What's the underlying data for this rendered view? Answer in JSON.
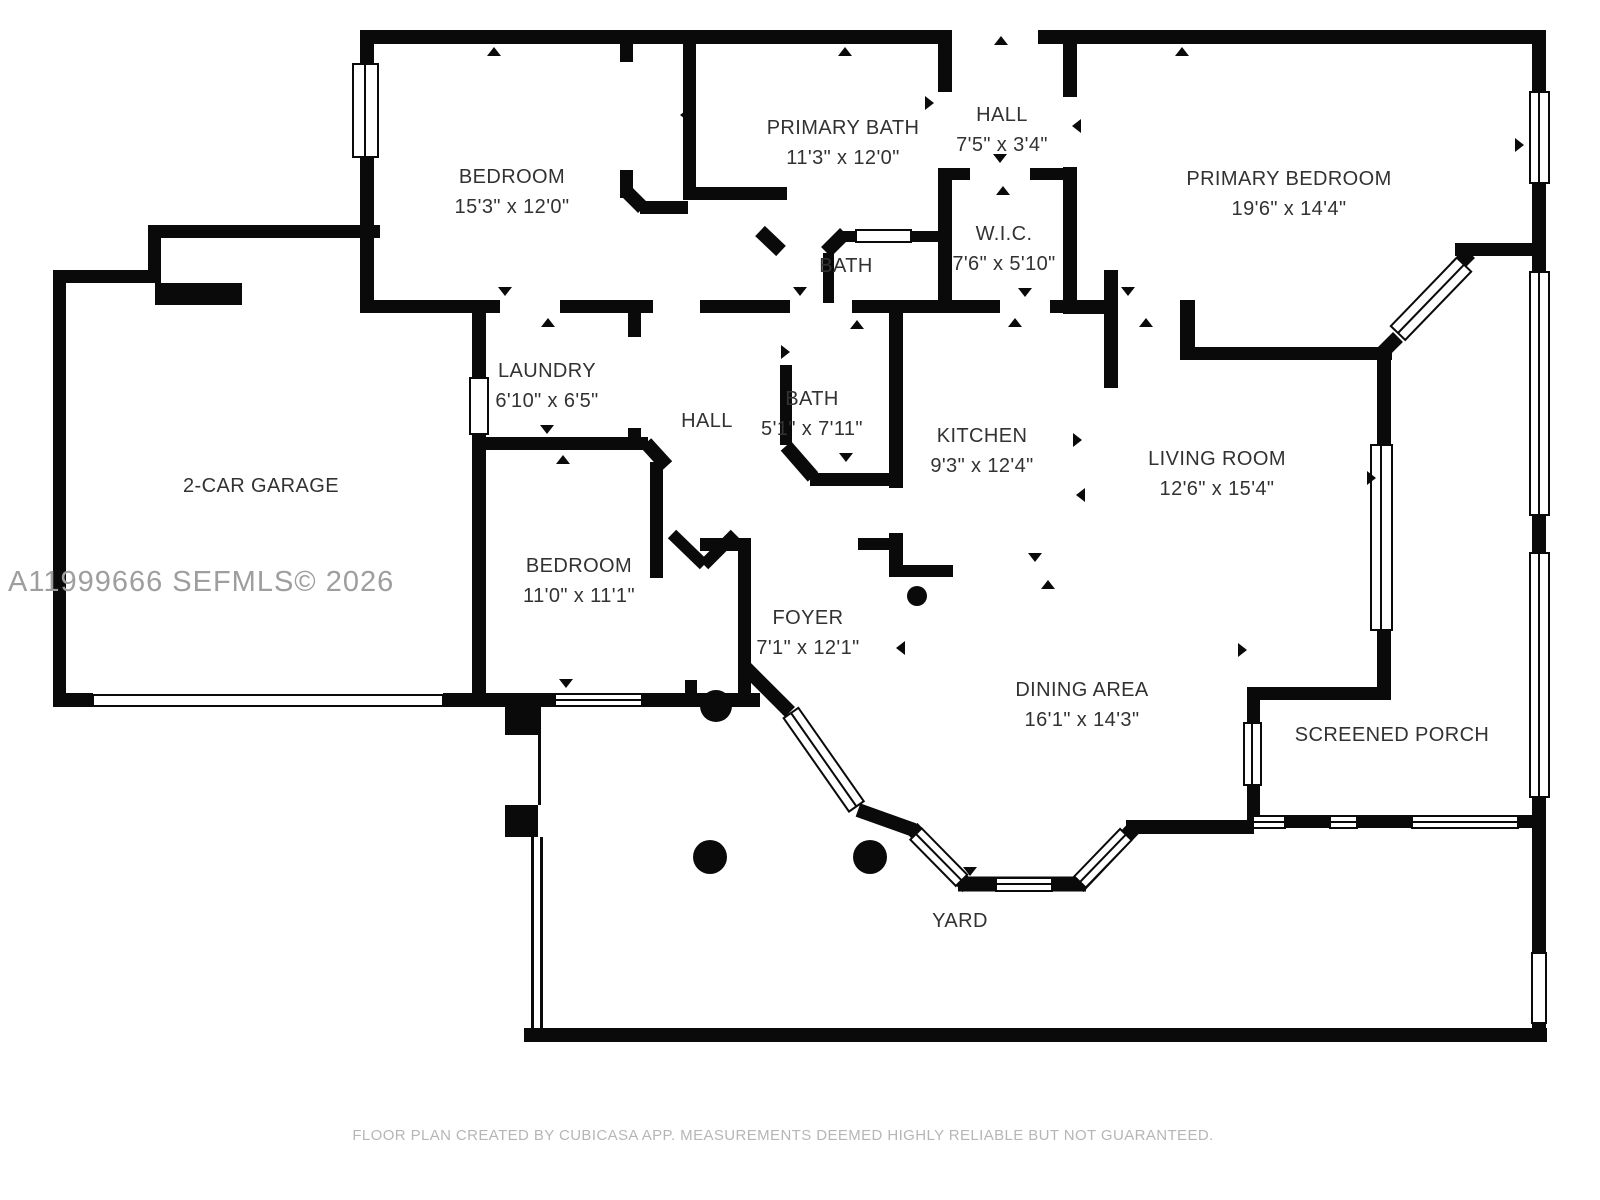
{
  "meta": {
    "document_type": "floor-plan",
    "colors": {
      "wall": "#0a0a0a",
      "label_text": "#323232",
      "watermark_text": "#9e9e9e",
      "footer_text": "#b6b6b6",
      "background": "#ffffff"
    }
  },
  "rooms": [
    {
      "name": "BEDROOM",
      "dims": "15'3\" x 12'0\""
    },
    {
      "name": "PRIMARY BATH",
      "dims": "11'3\" x 12'0\""
    },
    {
      "name": "HALL",
      "dims": "7'5\" x 3'4\""
    },
    {
      "name": "PRIMARY BEDROOM",
      "dims": "19'6\" x 14'4\""
    },
    {
      "name": "BATH",
      "dims": ""
    },
    {
      "name": "W.I.C.",
      "dims": "7'6\" x 5'10\""
    },
    {
      "name": "LAUNDRY",
      "dims": "6'10\" x 6'5\""
    },
    {
      "name": "HALL",
      "dims": ""
    },
    {
      "name": "BATH",
      "dims": "5'1\" x 7'11\""
    },
    {
      "name": "KITCHEN",
      "dims": "9'3\" x 12'4\""
    },
    {
      "name": "LIVING ROOM",
      "dims": "12'6\" x 15'4\""
    },
    {
      "name": "2-CAR GARAGE",
      "dims": ""
    },
    {
      "name": "BEDROOM",
      "dims": "11'0\" x 11'1\""
    },
    {
      "name": "FOYER",
      "dims": "7'1\" x 12'1\""
    },
    {
      "name": "DINING AREA",
      "dims": "16'1\" x 14'3\""
    },
    {
      "name": "SCREENED PORCH",
      "dims": ""
    },
    {
      "name": "YARD",
      "dims": ""
    }
  ],
  "watermark": "A11999666  SEFMLS© 2026",
  "footer": "FLOOR PLAN CREATED BY CUBICASA APP. MEASUREMENTS DEEMED HIGHLY RELIABLE BUT NOT GUARANTEED."
}
